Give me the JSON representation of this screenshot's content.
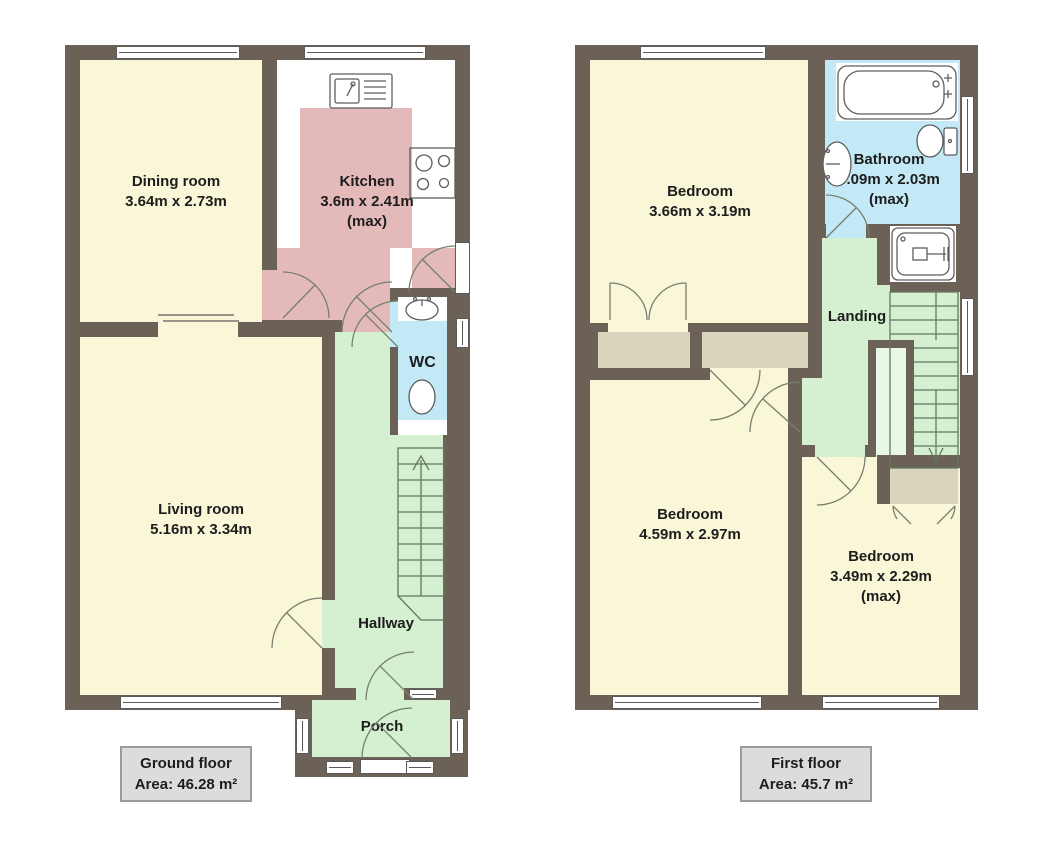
{
  "palette": {
    "wall": "#6b6156",
    "room_yellow": "#faf6d8",
    "kitchen_pink": "#e4b9ba",
    "circulation_green": "#d5efd1",
    "wet_room_blue": "#c3e9f7",
    "wardrobe_beige": "#d9d5bc",
    "label_box_gray": "#dcdcdc"
  },
  "ground_floor": {
    "title": "Ground floor",
    "area": "Area: 46.28 m²",
    "rooms": {
      "dining": {
        "name": "Dining room",
        "dims": "3.64m x 2.73m"
      },
      "kitchen": {
        "name": "Kitchen",
        "dims": "3.6m x 2.41m",
        "qualifier": "(max)"
      },
      "living": {
        "name": "Living room",
        "dims": "5.16m x 3.34m"
      },
      "wc": {
        "name": "WC"
      },
      "hallway": {
        "name": "Hallway"
      },
      "porch": {
        "name": "Porch"
      }
    }
  },
  "first_floor": {
    "title": "First floor",
    "area": "Area: 45.7 m²",
    "rooms": {
      "bedroom1": {
        "name": "Bedroom",
        "dims": "3.66m x 3.19m"
      },
      "bathroom": {
        "name": "Bathroom",
        "dims": "3.09m x 2.03m",
        "qualifier": "(max)"
      },
      "landing": {
        "name": "Landing"
      },
      "bedroom2": {
        "name": "Bedroom",
        "dims": "4.59m x 2.97m"
      },
      "bedroom3": {
        "name": "Bedroom",
        "dims": "3.49m x 2.29m",
        "qualifier": "(max)"
      }
    }
  }
}
